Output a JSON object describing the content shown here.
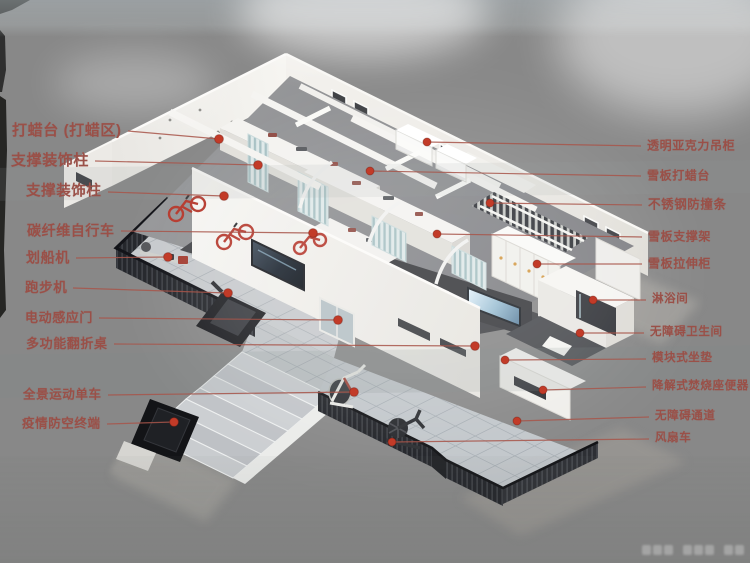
{
  "poster": {
    "background_color": "#dcd9d2",
    "label_color": "#9a5048",
    "line_color": "#a8554a",
    "dot_color": "#c23b28"
  },
  "callouts": {
    "left": [
      {
        "label": "打蜡台 (打蜡区)",
        "lx": 12,
        "ly": 131,
        "dx": 219,
        "dy": 139,
        "fs": 15
      },
      {
        "label": "支撑装饰柱",
        "lx": 11,
        "ly": 161,
        "dx": 258,
        "dy": 165,
        "fs": 15
      },
      {
        "label": "支撑装饰柱",
        "lx": 26,
        "ly": 192,
        "dx": 224,
        "dy": 196,
        "fs": 14.5
      },
      {
        "label": "碳纤维自行车",
        "lx": 27,
        "ly": 231,
        "dx": 313,
        "dy": 233,
        "fs": 14
      },
      {
        "label": "划船机",
        "lx": 26,
        "ly": 258,
        "dx": 168,
        "dy": 257,
        "fs": 14
      },
      {
        "label": "跑步机",
        "lx": 25,
        "ly": 288,
        "dx": 228,
        "dy": 293,
        "fs": 13.5
      },
      {
        "label": "电动感应门",
        "lx": 25,
        "ly": 318,
        "dx": 338,
        "dy": 320,
        "fs": 13
      },
      {
        "label": "多功能翻折桌",
        "lx": 26,
        "ly": 344,
        "dx": 475,
        "dy": 346,
        "fs": 13
      },
      {
        "label": "全景运动单车",
        "lx": 23,
        "ly": 395,
        "dx": 354,
        "dy": 392,
        "fs": 12.5
      },
      {
        "label": "疫情防空终端",
        "lx": 22,
        "ly": 424,
        "dx": 174,
        "dy": 422,
        "fs": 12.5
      }
    ],
    "right": [
      {
        "label": "透明亚克力吊柜",
        "lx": 647,
        "ly": 146,
        "dx": 427,
        "dy": 142,
        "fs": 12
      },
      {
        "label": "雪板打蜡台",
        "lx": 647,
        "ly": 176,
        "dx": 370,
        "dy": 171,
        "fs": 12
      },
      {
        "label": "不锈钢防撞条",
        "lx": 648,
        "ly": 205,
        "dx": 490,
        "dy": 203,
        "fs": 12.5
      },
      {
        "label": "雪板支撑架",
        "lx": 648,
        "ly": 237,
        "dx": 437,
        "dy": 234,
        "fs": 12
      },
      {
        "label": "雪板拉伸柜",
        "lx": 648,
        "ly": 264,
        "dx": 537,
        "dy": 264,
        "fs": 12
      },
      {
        "label": "淋浴间",
        "lx": 652,
        "ly": 300,
        "dx": 593,
        "dy": 300,
        "fs": 11.5
      },
      {
        "label": "无障碍卫生间",
        "lx": 650,
        "ly": 333,
        "dx": 580,
        "dy": 333,
        "fs": 11.5
      },
      {
        "label": "模块式坐垫",
        "lx": 652,
        "ly": 359,
        "dx": 505,
        "dy": 360,
        "fs": 11.5
      },
      {
        "label": "降解式焚烧座便器",
        "lx": 652,
        "ly": 387,
        "dx": 543,
        "dy": 390,
        "fs": 11.5
      },
      {
        "label": "无障碍通道",
        "lx": 655,
        "ly": 417,
        "dx": 517,
        "dy": 421,
        "fs": 11.5
      },
      {
        "label": "风扇车",
        "lx": 655,
        "ly": 439,
        "dx": 392,
        "dy": 442,
        "fs": 11.5
      }
    ]
  }
}
